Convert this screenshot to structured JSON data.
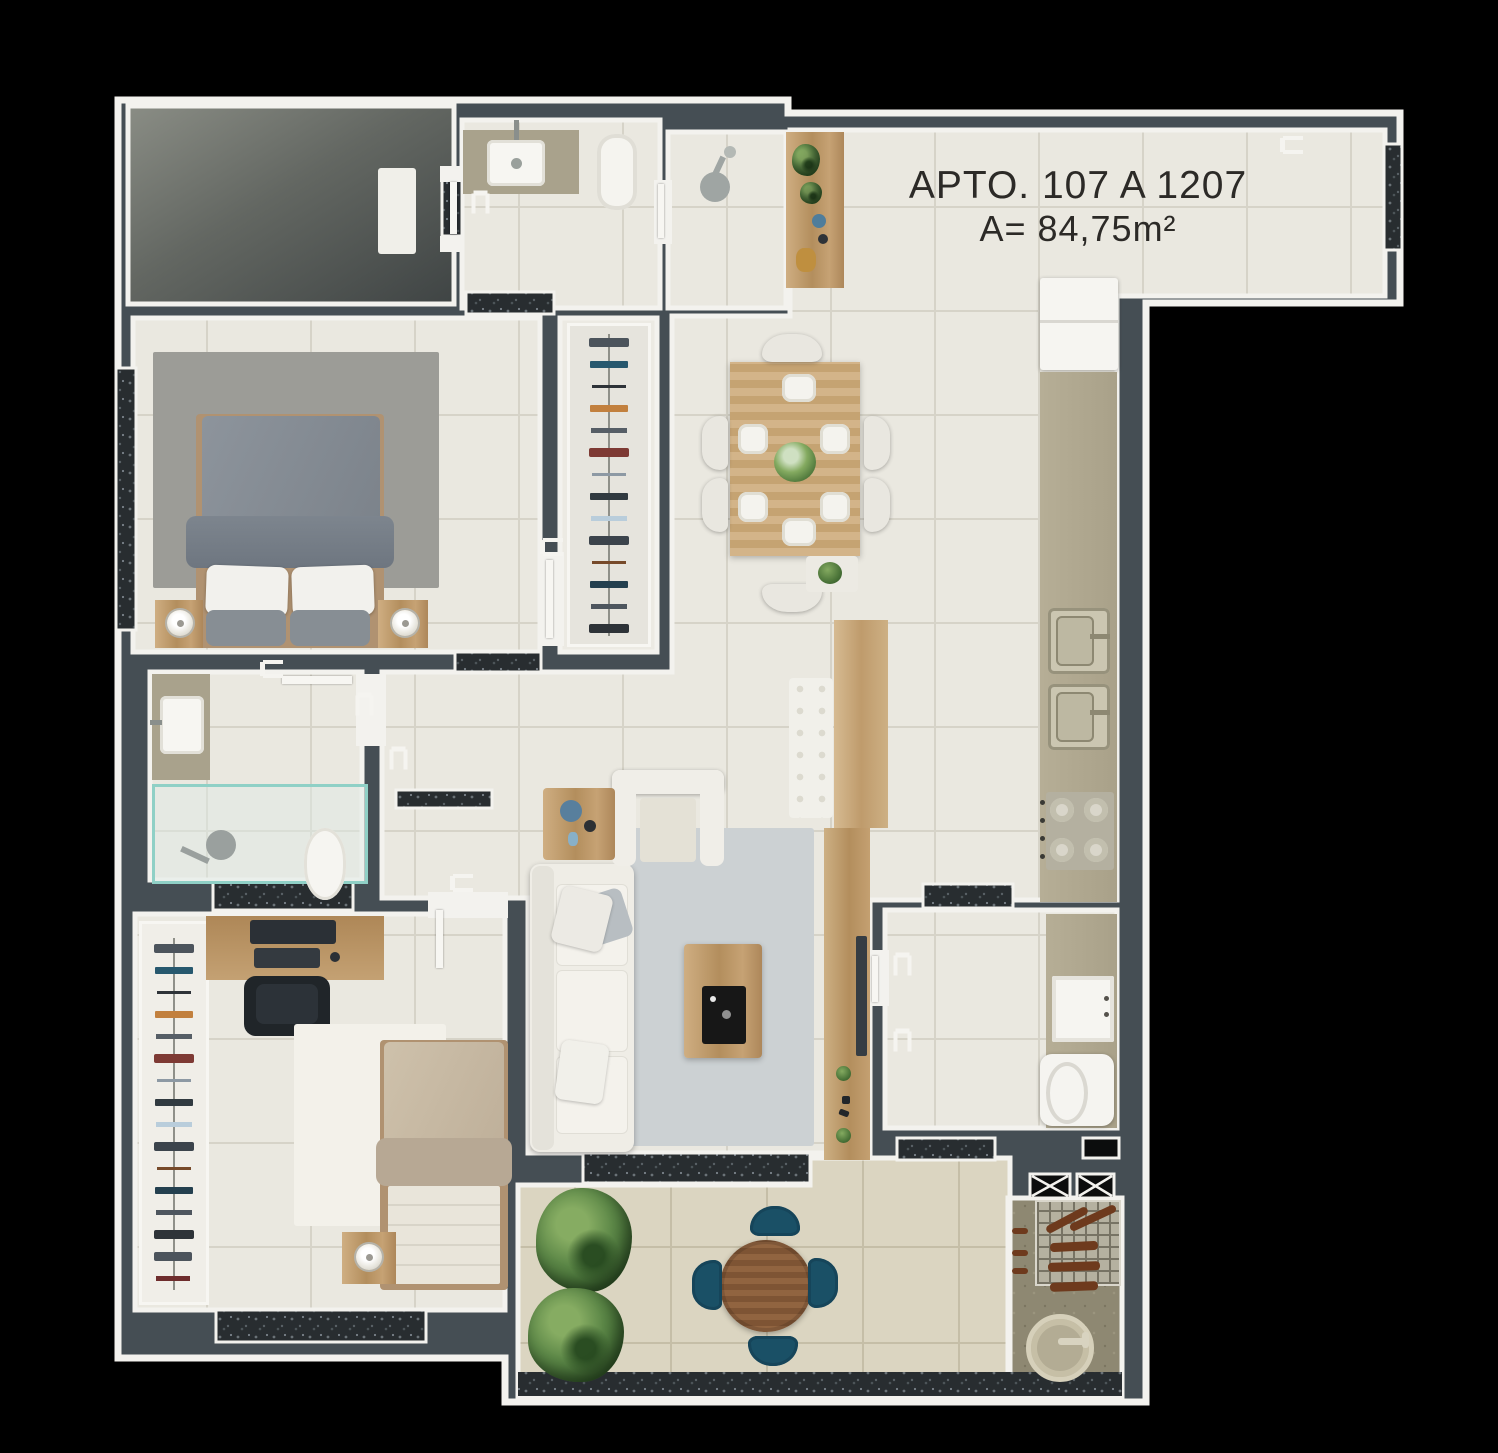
{
  "apartment": {
    "title": "APTO. 107 A 1207",
    "area": "A= 84,75m²"
  },
  "palette": {
    "background": "#000000",
    "wall_fill": "#454e54",
    "wall_line": "#f3f2ee",
    "tile_floor": "#eae8e0",
    "balcony_floor": "#dbd5c1",
    "concrete_hall": "#636762",
    "granite_window": "#282d30",
    "wood": "#bf9b6c",
    "sofa_white": "#efede6",
    "bed_gray": "#828991",
    "bed2_beige": "#c8bba4",
    "teal_chair": "#1a5066",
    "plant_green": "#477036",
    "text_color": "#2c2a27"
  }
}
